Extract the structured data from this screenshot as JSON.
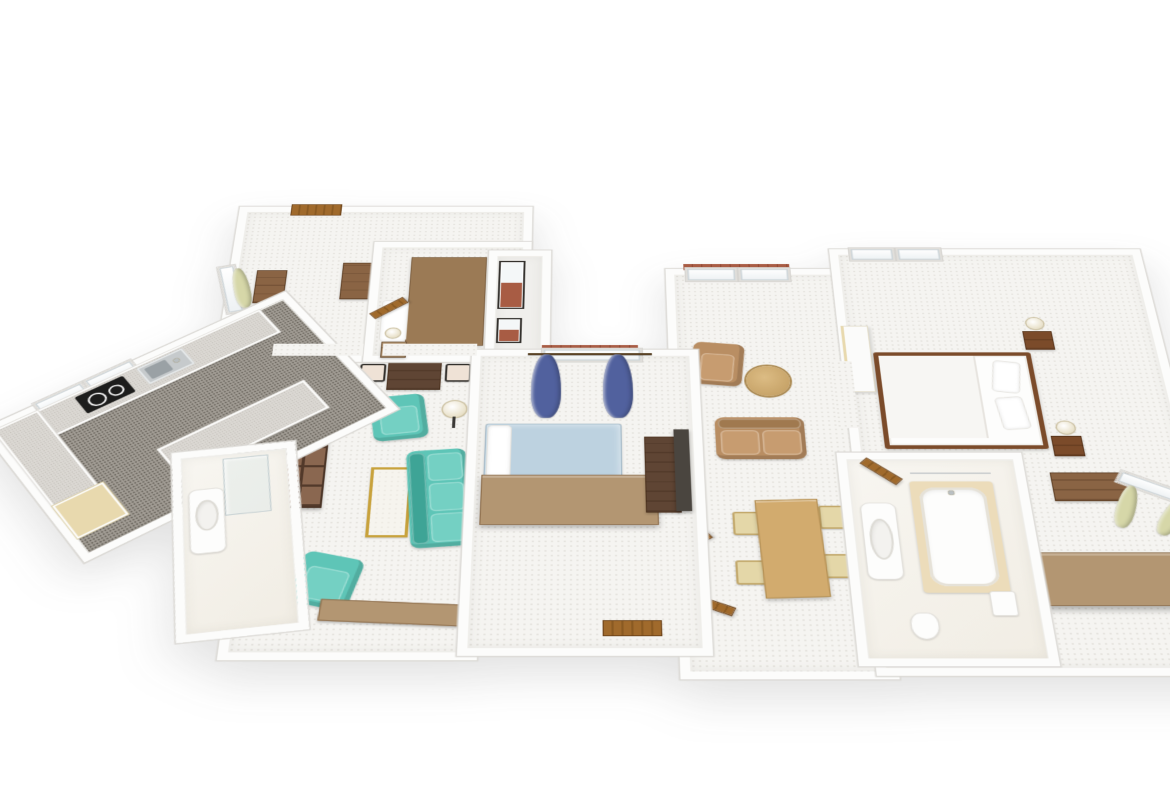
{
  "scene": {
    "type": "isometric-3d-floorplan",
    "background": "#ffffff",
    "description": "3D rendered floor plan of a two-bedroom apartment, viewed from above at an angle"
  },
  "colors": {
    "wall": "#fcfcfb",
    "wallEdge": "#dcdad6",
    "carpet": "#f5f4f1",
    "kitchenFloor": "#a29d95",
    "counterTop": "#dbd8d3",
    "cabinetBeige": "#e8d9ae",
    "cooktopBlack": "#1d1d1c",
    "sinkSteel": "#c6cacc",
    "teal": "#5ec5b7",
    "tealShade": "#3ea496",
    "sofaBrown": "#b98e63",
    "sofaBrownShade": "#a0794f",
    "woodDark": "#7b4b2a",
    "woodMid": "#8a6444",
    "woodTan": "#b39672",
    "woodBedCover": "#9b7a55",
    "woodLight": "#c9a36b",
    "diningWood": "#d2ab6e",
    "chairSeat": "#e4d7a8",
    "walnut": "#5f4534",
    "doorBrown": "#9a6326",
    "blueBed": "#bdd2e0",
    "blueCurtain": "#51619e",
    "greenCurtain": "#d6d7a8",
    "brick": "#a85c44",
    "gold": "#c8a23c",
    "lampShade": "#ddd0a8",
    "tileBeige": "#ecdcba",
    "mediaUnitDark": "#4a453f",
    "fixtureWhite": "#fdfdfc"
  },
  "rooms": [
    {
      "name": "kitchen",
      "furniture": [
        "u-shaped-counter",
        "cooktop",
        "sink",
        "beige-cabinet",
        "window",
        "window"
      ]
    },
    {
      "name": "entry-hall",
      "furniture": [
        "entry-door",
        "window-green-curtain",
        "dresser",
        "dresser",
        "paper-stand"
      ]
    },
    {
      "name": "small-bedroom",
      "furniture": [
        "bed-wood-cover",
        "pillow",
        "nightstand",
        "lamp",
        "open-door",
        "teal-curtain"
      ]
    },
    {
      "name": "lightwell",
      "furniture": [
        "brick-juliet-window",
        "brick-juliet-window"
      ]
    },
    {
      "name": "living-room",
      "furniture": [
        "bookshelf",
        "desk",
        "side-chair",
        "side-chair",
        "teal-armchair",
        "teal-armchair",
        "teal-sofa",
        "brass-coffee-table",
        "floor-lamp",
        "wood-bench",
        "open-door"
      ]
    },
    {
      "name": "small-bathroom",
      "furniture": [
        "vanity-sink",
        "glass-shower"
      ]
    },
    {
      "name": "middle-bedroom",
      "furniture": [
        "window-blue-curtains",
        "bed-blue",
        "wardrobe",
        "desk",
        "door"
      ]
    },
    {
      "name": "living-dining",
      "furniture": [
        "french-door",
        "french-door",
        "brown-armchair",
        "round-side-table",
        "brown-loveseat",
        "media-unit",
        "dining-table",
        "dining-chair",
        "dining-chair",
        "dining-chair",
        "dining-chair",
        "open-door",
        "open-door"
      ]
    },
    {
      "name": "main-bathroom",
      "furniture": [
        "bathtub",
        "vanity-sink",
        "toilet",
        "cistern",
        "open-door"
      ]
    },
    {
      "name": "master-bedroom",
      "furniture": [
        "window",
        "window",
        "double-bed",
        "nightstand-lamp",
        "nightstand-lamp",
        "wall-chest",
        "window-green-curtains",
        "wardrobe",
        "divider-panel"
      ]
    }
  ]
}
